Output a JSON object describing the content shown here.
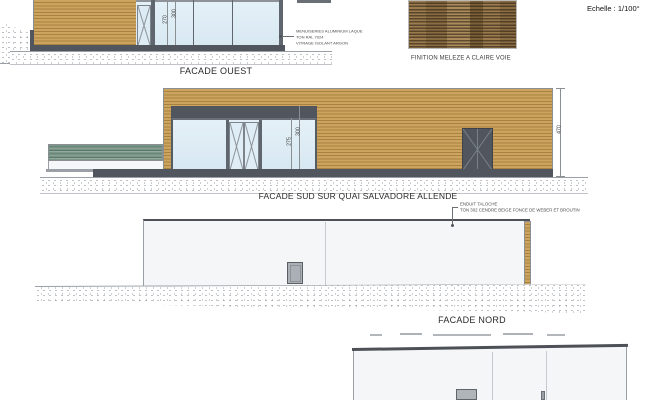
{
  "sheet": {
    "scale_label": "Echelle : 1/100°"
  },
  "facade_ouest": {
    "label": "FACADE OUEST",
    "annotation": {
      "line1": "MENUISERIES ALUMINIUM LAQUE",
      "line2": "TON RAL 7024",
      "line3": "VITRAGE ISOLANT ARGON"
    },
    "dimensions": [
      "270",
      "300"
    ]
  },
  "wood_sample": {
    "caption": "FINITION MELEZE A CLAIRE VOIE"
  },
  "facade_sud": {
    "label": "FACADE SUD SUR QUAI SALVADORE ALLENDE",
    "dimensions": [
      "275",
      "300",
      "470"
    ]
  },
  "facade_nord": {
    "label": "FACADE NORD",
    "annotation": {
      "line1": "ENDUIT TALOCHE",
      "line2": "TON 302 CENDRE BEIGE FONCE DE WEBER ET BROUTIN"
    }
  },
  "colors": {
    "wood": "#cda45f",
    "wood_line": "#a8823f",
    "dark_gray": "#51565e",
    "glass": "#dcebf4",
    "green_wall": "#73927f",
    "outline": "#8a8f94"
  }
}
